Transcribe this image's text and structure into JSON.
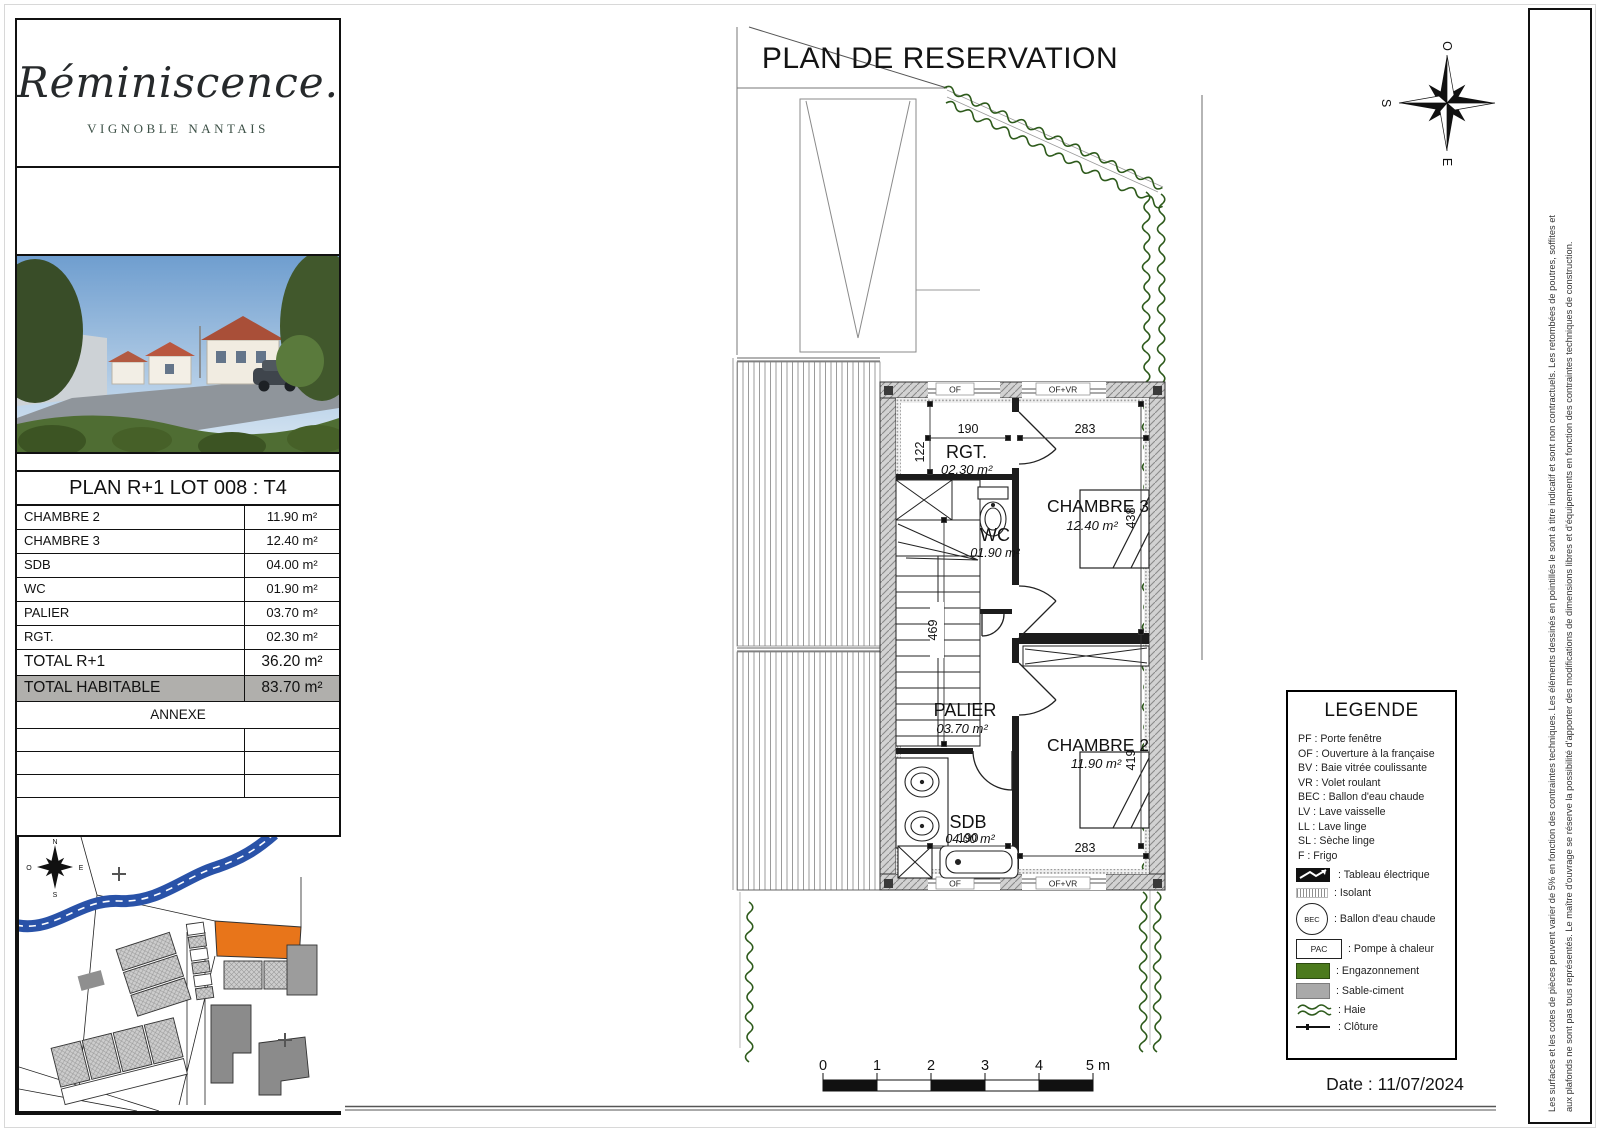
{
  "page": {
    "title": "PLAN DE RESERVATION",
    "date": "Date : 11/07/2024"
  },
  "branding": {
    "name": "Réminiscence.",
    "subtitle": "VIGNOBLE NANTAIS"
  },
  "summary": {
    "title": "PLAN R+1 LOT 008 : T4",
    "rows": [
      {
        "label": "CHAMBRE 2",
        "value": "11.90  m²"
      },
      {
        "label": "CHAMBRE 3",
        "value": "12.40  m²"
      },
      {
        "label": "SDB",
        "value": "04.00  m²"
      },
      {
        "label": "WC",
        "value": "01.90  m²"
      },
      {
        "label": "PALIER",
        "value": "03.70  m²"
      },
      {
        "label": "RGT.",
        "value": "02.30  m²"
      }
    ],
    "totals": [
      {
        "label": "TOTAL R+1",
        "value": "36.20 m²"
      },
      {
        "label": "TOTAL HABITABLE",
        "value": "83.70 m²"
      }
    ],
    "annexe_title": "ANNEXE"
  },
  "floorplan": {
    "rooms": {
      "rgt": {
        "name": "RGT.",
        "area": "02.30 m²"
      },
      "wc": {
        "name": "WC",
        "area": "01.90 m²"
      },
      "chambre3": {
        "name": "CHAMBRE 3",
        "area": "12.40 m²"
      },
      "palier": {
        "name": "PALIER",
        "area": "03.70 m²"
      },
      "sdb": {
        "name": "SDB",
        "area": "04.00 m²"
      },
      "chambre2": {
        "name": "CHAMBRE 2",
        "area": "11.90 m²"
      }
    },
    "dims": {
      "rgt_width": "190",
      "chambre3_width": "283",
      "rgt_height": "122",
      "chambre3_height": "438",
      "stairs_height": "469",
      "chambre2_height": "419",
      "sdb_width": "190",
      "chambre2_width": "283"
    },
    "openings": {
      "top_left": "OF",
      "top_right": "OF+VR",
      "bottom_left": "OF",
      "bottom_right": "OF+VR"
    }
  },
  "legend": {
    "title": "LEGENDE",
    "abbreviations": [
      "PF : Porte fenêtre",
      "OF : Ouverture à la française",
      "BV : Baie vitrée coulissante",
      "VR : Volet roulant",
      "BEC : Ballon d'eau chaude",
      "LV : Lave vaisselle",
      "LL : Lave linge",
      "SL : Sèche linge",
      "F : Frigo"
    ],
    "items": [
      {
        "label": ": Tableau électrique"
      },
      {
        "label": ": Isolant"
      },
      {
        "badge": "BEC",
        "label": ": Ballon d'eau chaude"
      },
      {
        "badge": "PAC",
        "label": ": Pompe à chaleur"
      },
      {
        "label": ": Engazonnement"
      },
      {
        "label": ": Sable-ciment"
      },
      {
        "label": ": Haie"
      },
      {
        "label": ": Clôture"
      }
    ]
  },
  "scalebar": {
    "ticks": [
      "0",
      "1",
      "2",
      "3",
      "4"
    ],
    "end": "5 m"
  },
  "compass": {
    "main": {
      "top": "O",
      "left": "S",
      "bottom": "E",
      "right": "N"
    },
    "site": {
      "top": "N",
      "left": "O",
      "bottom": "S",
      "right": "E"
    }
  },
  "disclaimer": {
    "line1": "Les surfaces et les cotes de pièces peuvent varier de 5% en fonction des contraintes techniques. Les éléments dessinés en pointillés le sont à titre indicatif et sont non contractuels. Les retombées de poutres, soffites et",
    "line2": "aux plafonds ne sont pas tous représentés. Le maître d'ouvrage se réserve la possibilité d'apporter des modifications de dimensions libres et d'équipements en fonction des contraintes techniques de construction."
  },
  "colors": {
    "lot": "#e8751a",
    "river": "#2952a8",
    "grass": "#4c7a1d",
    "sand": "#a9a9a9",
    "hedge": "#2d5a1b",
    "highlight_row": "#b0afac"
  }
}
